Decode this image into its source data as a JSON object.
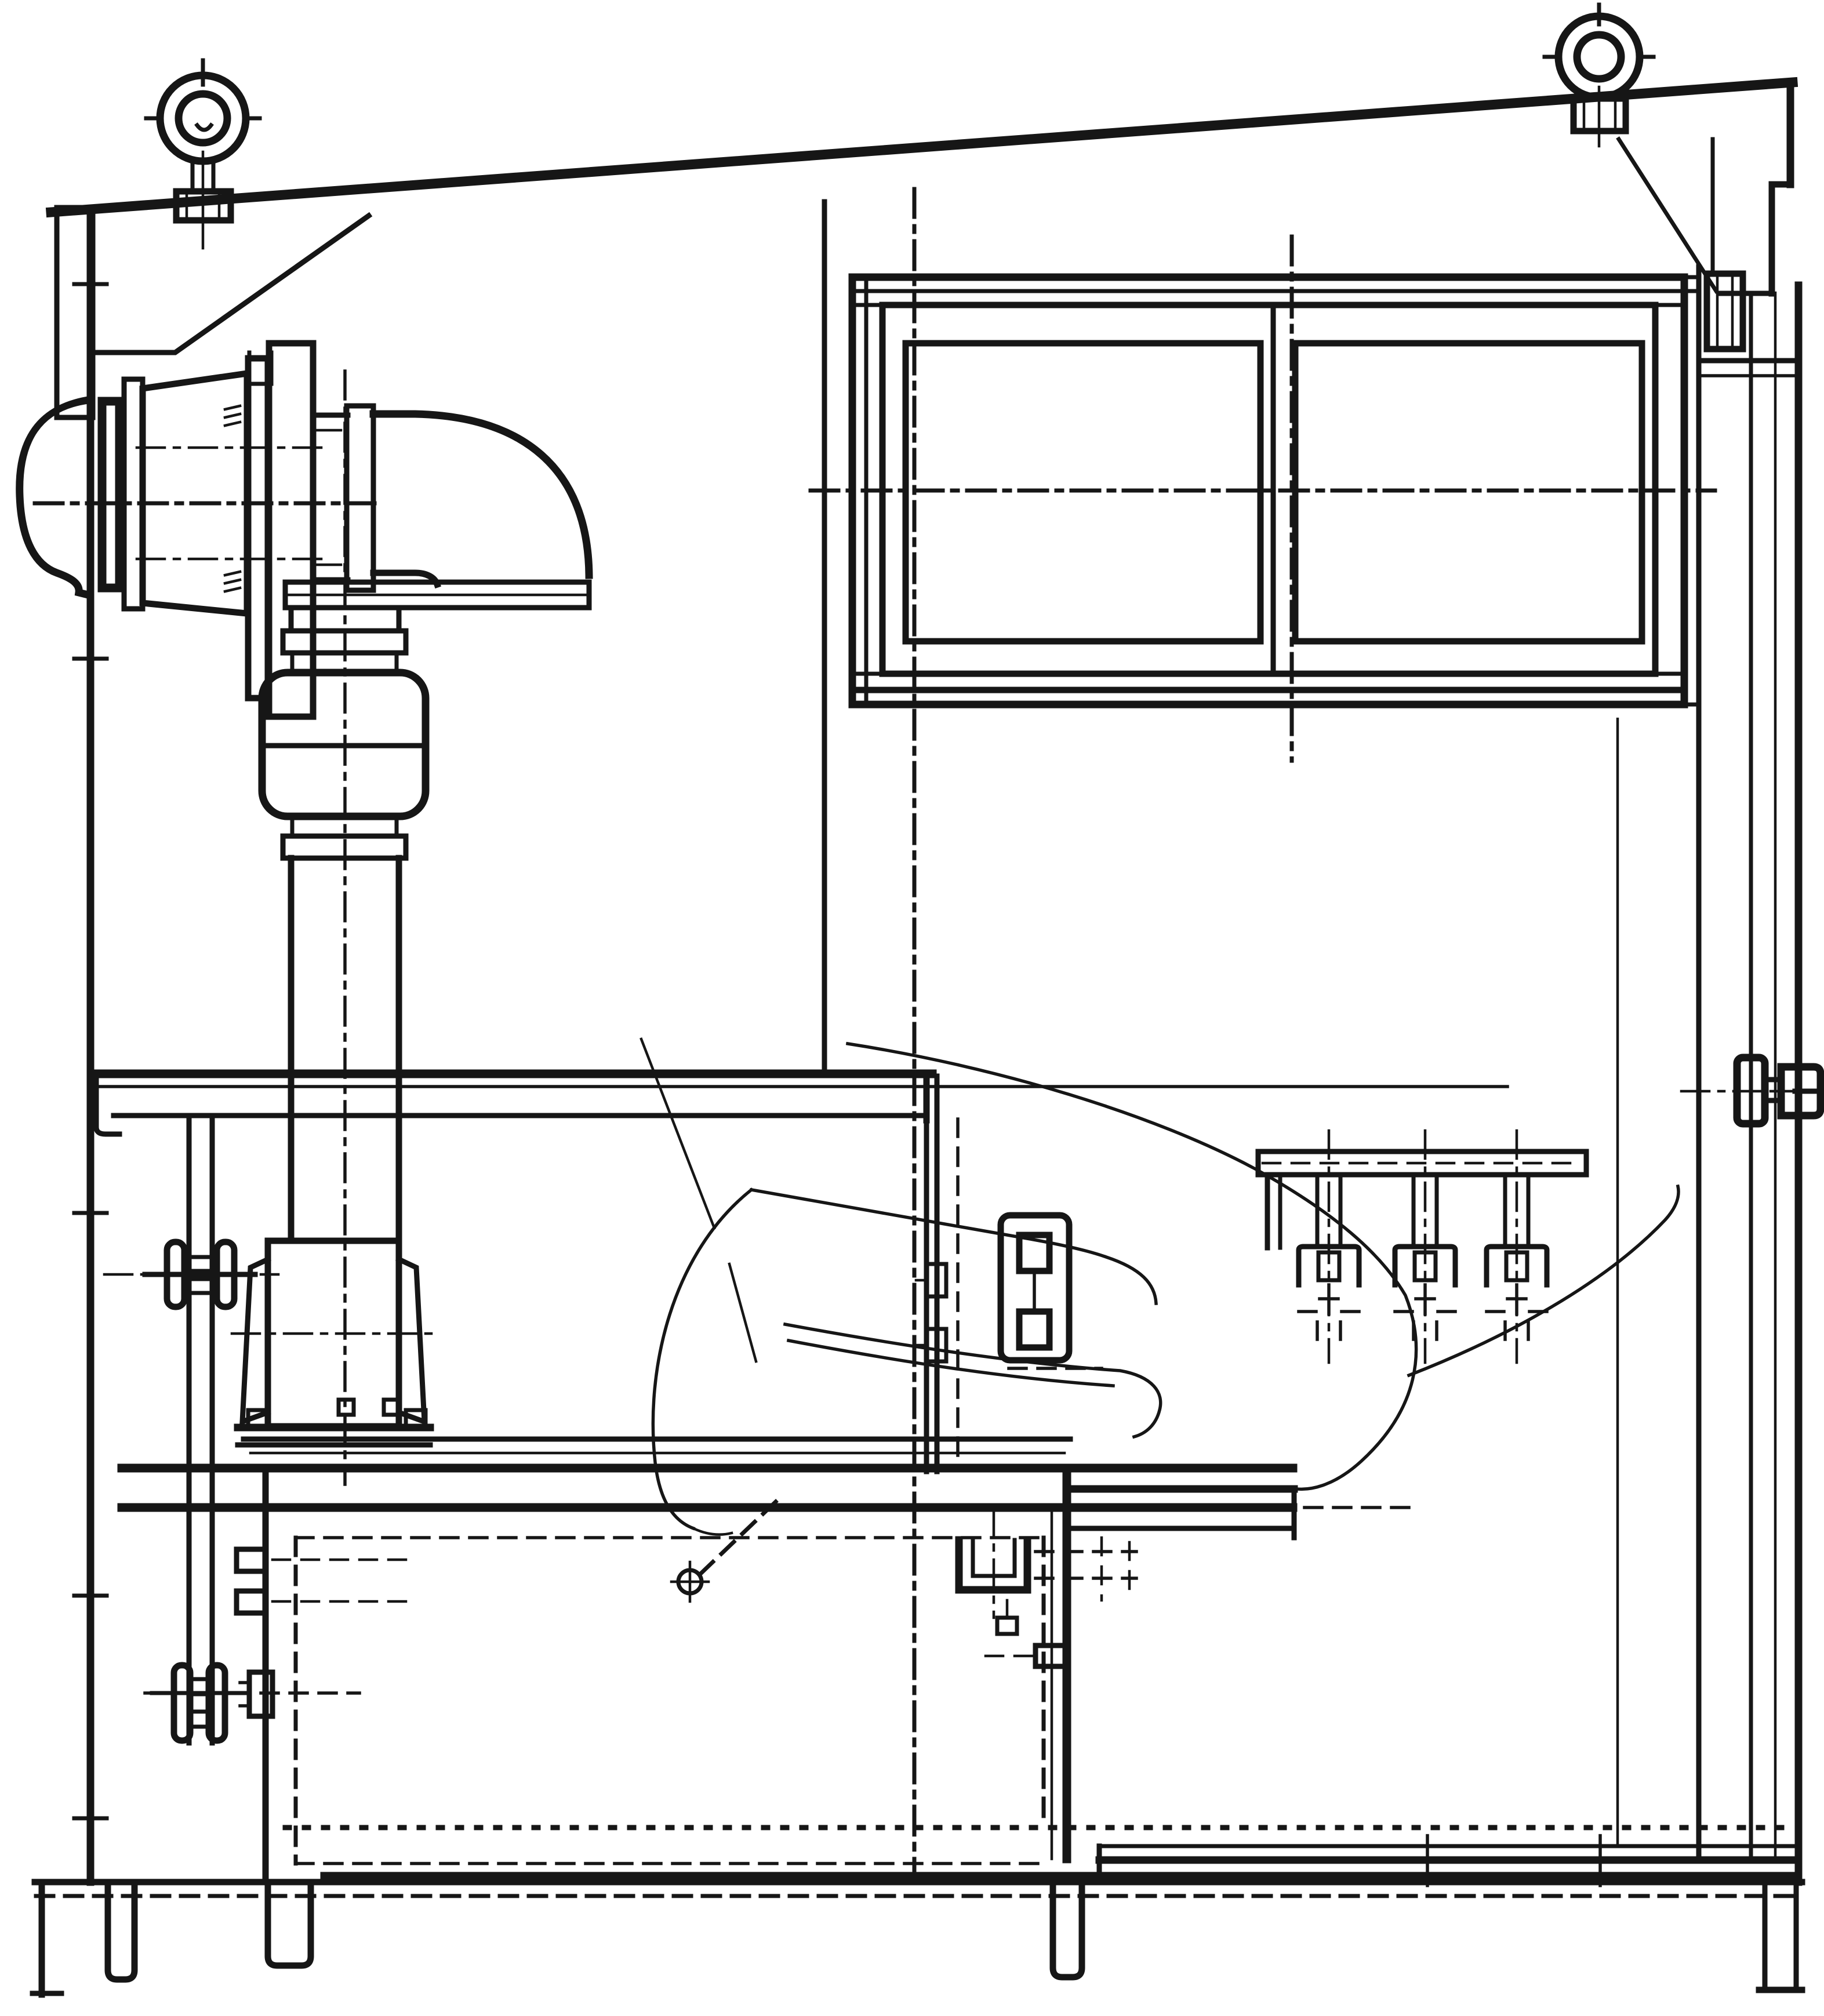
{
  "meta": {
    "title": "Equipment cabin side elevation section drawing",
    "drawing_type": "technical line drawing",
    "view": "side elevation / section",
    "paper_color": "#ffffff",
    "ink_color": "#161616",
    "text_labels_visible": "none"
  },
  "linework": {
    "centerline_dash": "48 16 10 16",
    "hidden_dash": "30 20",
    "dotted_dash": "7 26",
    "serrated_dash": "30 12"
  },
  "components": {
    "roof": "sloped roof line rising left to right",
    "left_lifting_eye": "eye bolt with concentric rings on base plate, left roof",
    "right_lifting_eye": "eye bolt with concentric rings on base plate, right roof",
    "left_eave_bracket": "channel and gusset at left eave",
    "right_fascia": "stepped overhang fascia at right eave",
    "left_wall": "left exterior wall with centerline ticks",
    "right_wall_door": "right wall with door frame lines, hinge block, handle and sill",
    "window": "two-pane sliding window with outer frame, mid frame, mullion and centerlines",
    "blower": "exterior weather hood, wall flange and fan housing",
    "duct": "elbow duct with flanged joint, flexible coupling with clamp bands, vertical drop duct",
    "motor": "motor / gearbox block on tank top with flared mounts and base plate",
    "chain_drive": "chain with upper and lower sprockets and wall bolts",
    "tank": "lower tank with flanged serrated rim, hidden inset lines and wall bolts",
    "platform_band": "serrated raised platform edge right of tank",
    "partition": "interior partition post and panel with hidden edge",
    "shelf": "horizontal shelf / deck rail at mid height",
    "seat": "operator seat drawn in phantom lines with pivot symbol and hose curves",
    "outlet_box": "electrical box with two square knockouts on partition",
    "wall_bracket": "rail-mounted bracket with three U-clamps and centerlines",
    "u_bracket": "U-shaped pipe clamp below seat",
    "floor": "floor line with serrated tread edge, dotted and dashed datum rows",
    "legs": "support feet below floor at left wall, tank and right wall"
  }
}
